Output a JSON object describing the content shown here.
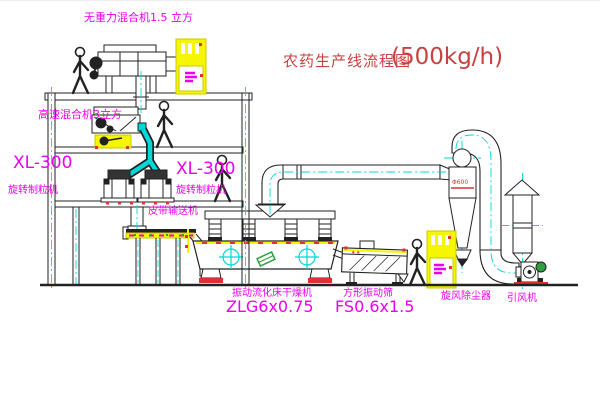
{
  "title": {
    "text_zh": "农药生产线流程图",
    "capacity": "(500kg/h)"
  },
  "equipment_labels": {
    "gravity_mixer": "无重力混合机1.5 立方",
    "high_speed_mixer": "高速混合机3立方",
    "granulator_left_model": "XL-300",
    "granulator_left_name": "旋转制粒机",
    "granulator_mid_model": "XL-300",
    "granulator_mid_name": "旋转制粒机",
    "belt_conveyor": "皮带输送机",
    "fluid_bed_dryer_name": "振动流化床干燥机",
    "fluid_bed_dryer_model": "ZLG6x0.75",
    "vibrating_screen_name": "方形振动筛",
    "vibrating_screen_model": "FS0.6x1.5",
    "cyclone_collector": "旋风除尘器",
    "cyclone_size": "Φ600",
    "induced_draft_fan": "引风机"
  },
  "colors": {
    "line": "#222222",
    "pipe_cyan": "#00d8d8",
    "cabinet_yellow": "#f6f600",
    "label_magenta": "#ea00ea",
    "accent_red": "#e03030",
    "title_red": "#c94141",
    "green": "#2e9e40",
    "background": "#ffffff"
  }
}
